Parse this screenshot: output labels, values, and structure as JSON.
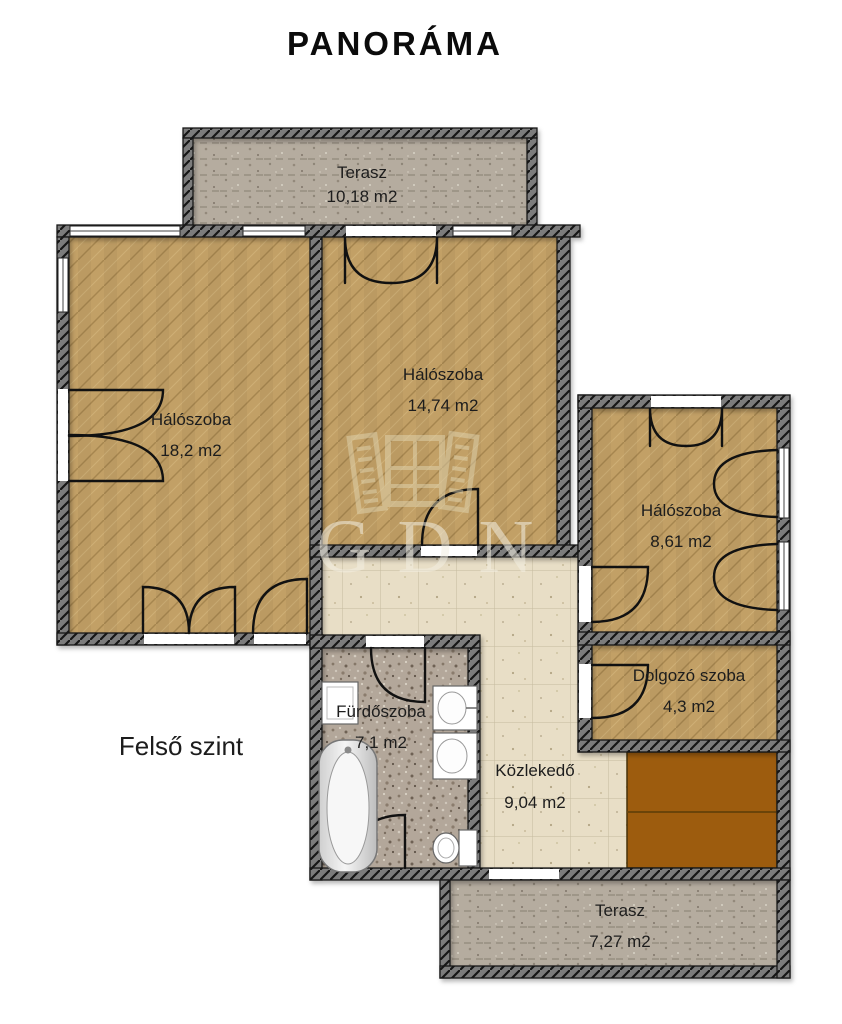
{
  "title": "PANORÁMA",
  "floor_label": "Felső szint",
  "watermark": {
    "text": "GDN",
    "icon": "window-shutters-icon"
  },
  "rooms": [
    {
      "key": "terasz-top",
      "name": "Terasz",
      "area": "10,18 m2"
    },
    {
      "key": "haloszoba-large",
      "name": "Hálószoba",
      "area": "18,2 m2"
    },
    {
      "key": "haloszoba-middle",
      "name": "Hálószoba",
      "area": "14,74 m2"
    },
    {
      "key": "haloszoba-small",
      "name": "Hálószoba",
      "area": "8,61 m2"
    },
    {
      "key": "dolgozo-szoba",
      "name": "Dolgozó szoba",
      "area": "4,3 m2"
    },
    {
      "key": "furdoszoba",
      "name": "Fürdőszoba",
      "area": "7,1 m2"
    },
    {
      "key": "kozlekedo",
      "name": "Közlekedő",
      "area": "9,04 m2"
    },
    {
      "key": "terasz-bottom",
      "name": "Terasz",
      "area": "7,27 m2"
    }
  ],
  "colors": {
    "carpet": "#c2a066",
    "terrace": "#b5ac9f",
    "hall_tile": "#e8dec6",
    "bath_tile": "#b3a79a",
    "wardrobe_brown": "#9d5c0e",
    "wall": "#7b7b7b",
    "text": "#1d1d1d"
  }
}
